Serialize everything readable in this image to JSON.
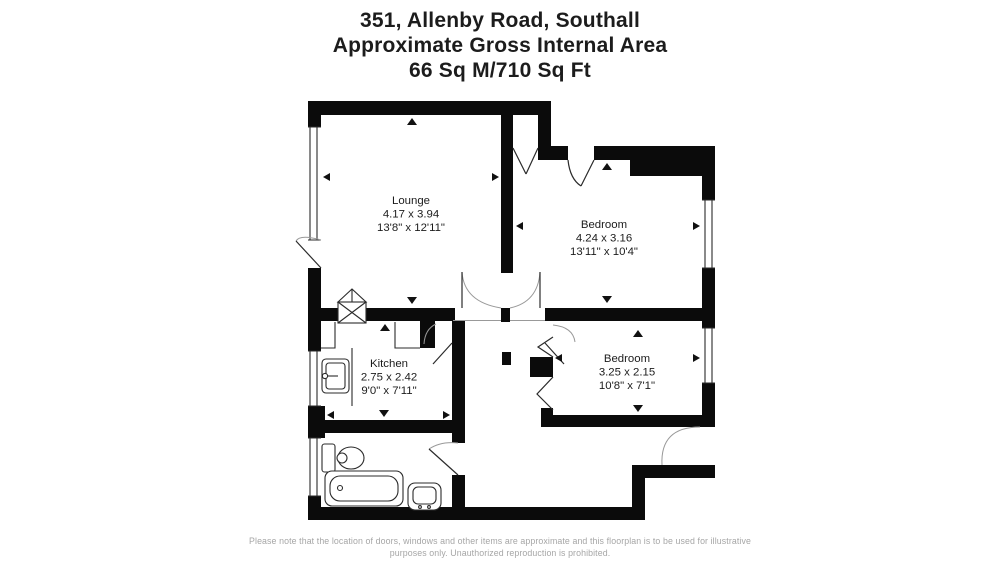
{
  "title": {
    "address": "351, Allenby Road, Southall",
    "area_label": "Approximate Gross Internal Area",
    "area_value": "66 Sq M/710 Sq Ft"
  },
  "rooms": {
    "lounge": {
      "name": "Lounge",
      "metric": "4.17 x 3.94",
      "imperial": "13'8\" x 12'11\""
    },
    "bedroom1": {
      "name": "Bedroom",
      "metric": "4.24 x 3.16",
      "imperial": "13'11\" x 10'4\""
    },
    "kitchen": {
      "name": "Kitchen",
      "metric": "2.75 x 2.42",
      "imperial": "9'0\" x 7'11\""
    },
    "bedroom2": {
      "name": "Bedroom",
      "metric": "3.25 x 2.15",
      "imperial": "10'8\" x 7'1\""
    }
  },
  "footer": {
    "line1": "Please note that the location of doors, windows and other items are approximate and this floorplan is to be used for illustrative",
    "line2": "purposes only. Unauthorized reproduction is prohibited."
  },
  "colors": {
    "wall": "#0b0b0b",
    "text": "#1c1c1c",
    "footer_text": "#a6a6a6",
    "arc": "#999999",
    "background": "#ffffff"
  }
}
